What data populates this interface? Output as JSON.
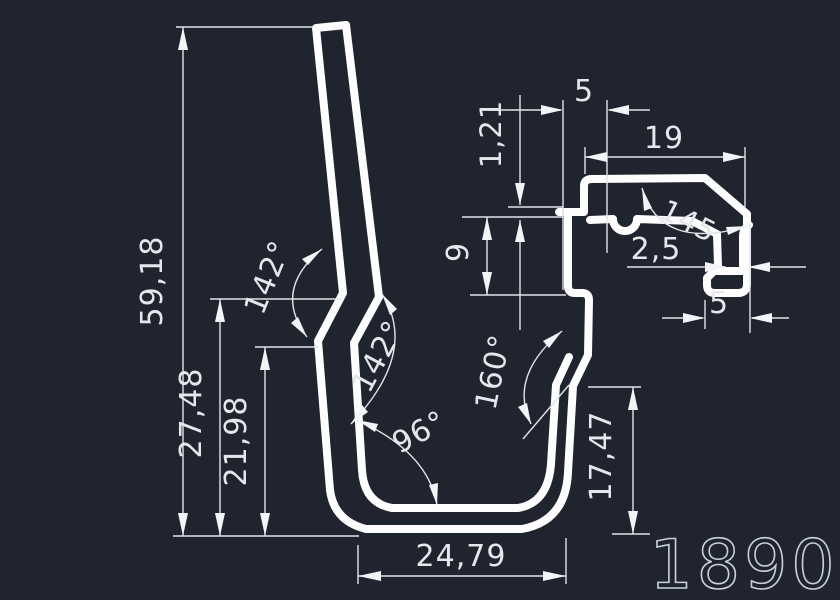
{
  "app": {
    "background_color": "#20242f",
    "profile_line_color": "#fdfdfe",
    "dimension_line_color": "#dfe3e8",
    "part_number_color": "#c9cfd8"
  },
  "drawing": {
    "part_number": "1890",
    "linear_dimensions": {
      "overall_height": "59,18",
      "height_to_upper_bend": "27,48",
      "height_to_lower_bend": "21,98",
      "channel_inner_width": "24,79",
      "right_wall_height": "17,47",
      "mouth_wall_height": "9",
      "ledge_thickness": "1,21",
      "ledge_width": "5",
      "arm_width": "19",
      "hook_wall_thickness": "2,5",
      "hook_foot_width": "5"
    },
    "angle_dimensions": {
      "upper_bend": "142°",
      "lower_bend": "142°",
      "base_corner": "96°",
      "right_wall_kink": "160°",
      "arm_chamfer": "145"
    }
  }
}
